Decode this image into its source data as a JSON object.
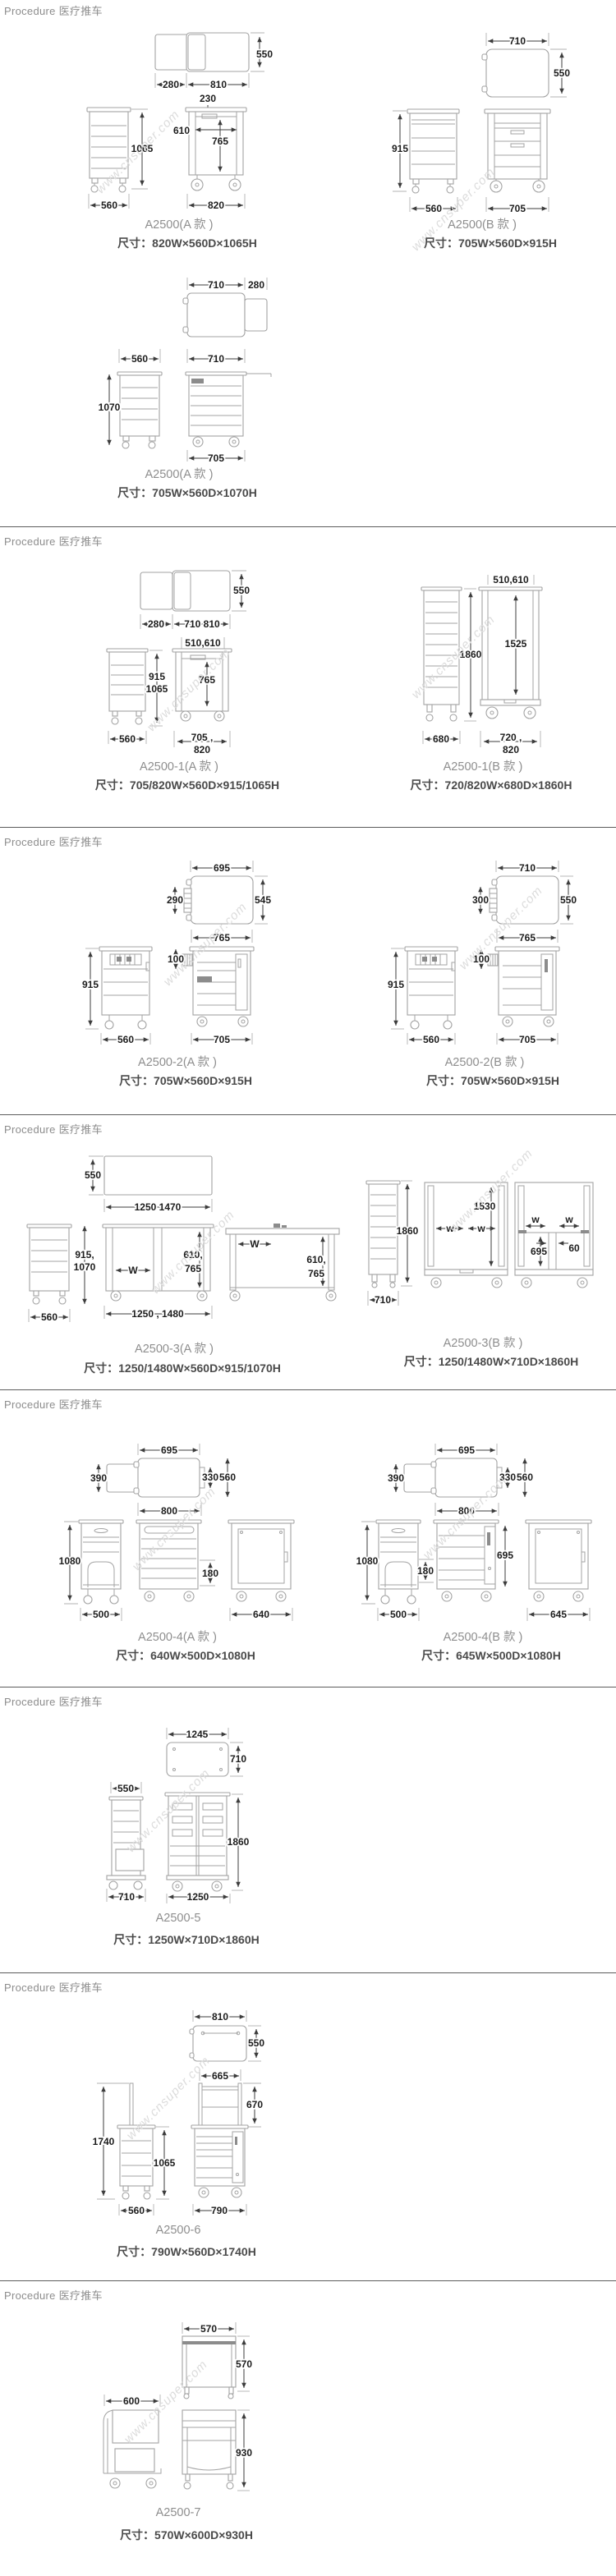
{
  "watermark": "www.cnsuper.com",
  "sections": [
    {
      "header": "Procedure 医疗推车",
      "models": [
        {
          "name": "A2500(A 款 )",
          "size": "尺寸：820W×560D×1065H",
          "dims": [
            "550",
            "280",
            "810",
            "230",
            "610",
            "765",
            "1065",
            "560",
            "820"
          ]
        },
        {
          "name": "A2500(B 款 )",
          "size": "尺寸：705W×560D×915H",
          "dims": [
            "710",
            "550",
            "915",
            "560",
            "705"
          ]
        },
        {
          "name": "A2500(A 款 )",
          "size": "尺寸：705W×560D×1070H",
          "dims": [
            "710",
            "280",
            "560",
            "710",
            "1070",
            "705"
          ]
        }
      ]
    },
    {
      "header": "Procedure 医疗推车",
      "models": [
        {
          "name": "A2500-1(A 款 )",
          "size": "尺寸：705/820W×560D×915/1065H",
          "dims": [
            "550",
            "280",
            "710 810",
            "510,610",
            "915",
            "1065",
            "765",
            "560",
            "705 ,",
            "820"
          ]
        },
        {
          "name": "A2500-1(B 款 )",
          "size": "尺寸：720/820W×680D×1860H",
          "dims": [
            "510,610",
            "1860",
            "1525",
            "680",
            "720 ,",
            "820"
          ]
        }
      ]
    },
    {
      "header": "Procedure 医疗推车",
      "models": [
        {
          "name": "A2500-2(A 款 )",
          "size": "尺寸：705W×560D×915H",
          "dims": [
            "695",
            "290",
            "545",
            "765",
            "100",
            "915",
            "560",
            "705"
          ]
        },
        {
          "name": "A2500-2(B 款 )",
          "size": "尺寸：705W×560D×915H",
          "dims": [
            "710",
            "300",
            "550",
            "765",
            "100",
            "915",
            "560",
            "705"
          ]
        }
      ]
    },
    {
      "header": "Procedure 医疗推车",
      "models": [
        {
          "name": "A2500-3(A 款 )",
          "size": "尺寸：1250/1480W×560D×915/1070H",
          "dims": [
            "550",
            "1250 1470",
            "915,",
            "1070",
            "560",
            "W",
            "610,",
            "765",
            "1250 , 1480",
            "W",
            "610,",
            "765"
          ]
        },
        {
          "name": "A2500-3(B 款 )",
          "size": "尺寸：1250/1480W×710D×1860H",
          "dims": [
            "1860",
            "710",
            "1530",
            "w",
            "w",
            "w",
            "w",
            "695",
            "60"
          ]
        }
      ]
    },
    {
      "header": "Procedure 医疗推车",
      "models": [
        {
          "name": "A2500-4(A 款 )",
          "size": "尺寸：640W×500D×1080H",
          "dims": [
            "695",
            "390",
            "330",
            "560",
            "800",
            "1080",
            "500",
            "180",
            "640"
          ]
        },
        {
          "name": "A2500-4(B 款 )",
          "size": "尺寸：645W×500D×1080H",
          "dims": [
            "695",
            "390",
            "330",
            "560",
            "800",
            "1080",
            "500",
            "180",
            "695",
            "645"
          ]
        }
      ]
    },
    {
      "header": "Procedure 医疗推车",
      "models": [
        {
          "name": "A2500-5",
          "size": "尺寸：1250W×710D×1860H",
          "dims": [
            "1245",
            "710",
            "550",
            "1860",
            "710",
            "1250"
          ]
        }
      ]
    },
    {
      "header": "Procedure 医疗推车",
      "models": [
        {
          "name": "A2500-6",
          "size": "尺寸：790W×560D×1740H",
          "dims": [
            "810",
            "550",
            "665",
            "670",
            "1740",
            "1065",
            "560",
            "790"
          ]
        }
      ]
    },
    {
      "header": "Procedure 医疗推车",
      "models": [
        {
          "name": "A2500-7",
          "size": "尺寸：570W×600D×930H",
          "dims": [
            "570",
            "570",
            "600",
            "930"
          ]
        }
      ]
    }
  ]
}
